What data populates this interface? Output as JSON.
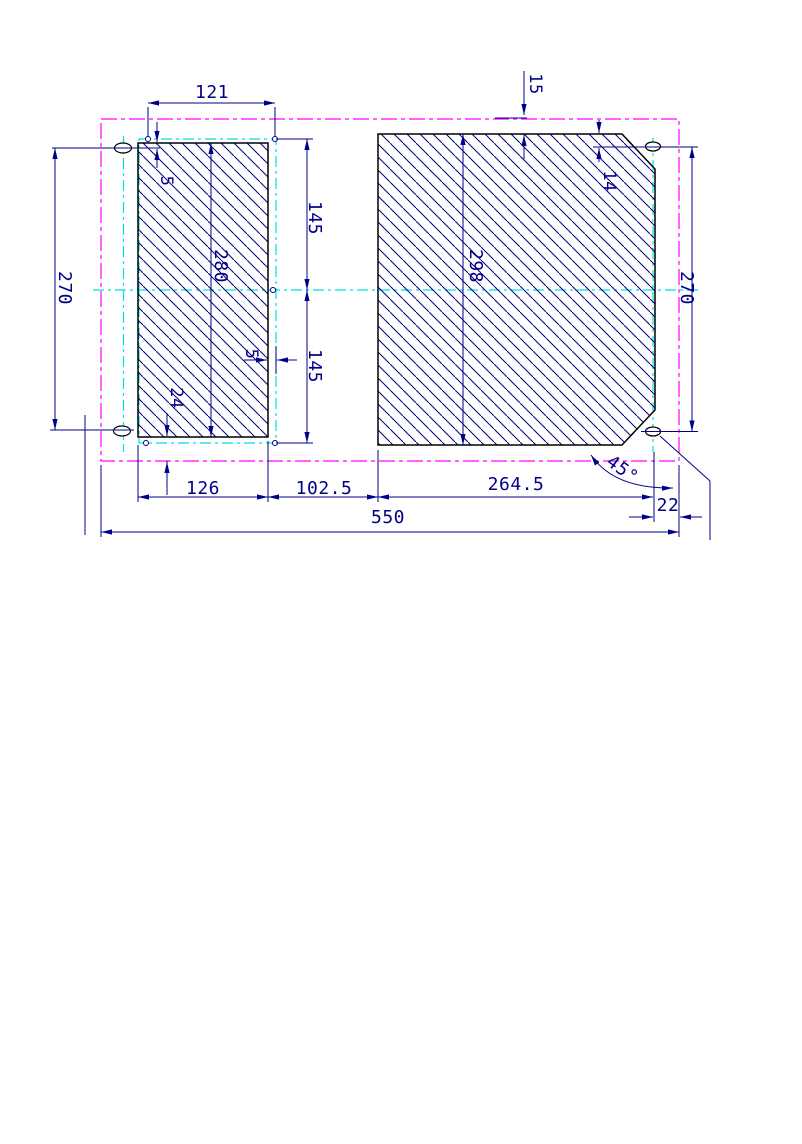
{
  "drawing": {
    "title": "plate-dimension-drawing",
    "dims": {
      "d121": "121",
      "d15": "15",
      "d5_top": "5",
      "d145_top": "145",
      "d280": "280",
      "d270_left": "270",
      "d298": "298",
      "d14": "14",
      "d270_right": "270",
      "d5_side": "5",
      "d145_bottom": "145",
      "d24": "24",
      "d126": "126",
      "d102_5": "102.5",
      "d264_5": "264.5",
      "d22": "22",
      "d550": "550",
      "angle45": "45°"
    },
    "colors": {
      "dimension": "#00008B",
      "hatch": "#000080",
      "outline": "#000000",
      "phantom_line": "#FF00FF",
      "center_line": "#00E0E0",
      "background": "#FFFFFF"
    }
  }
}
